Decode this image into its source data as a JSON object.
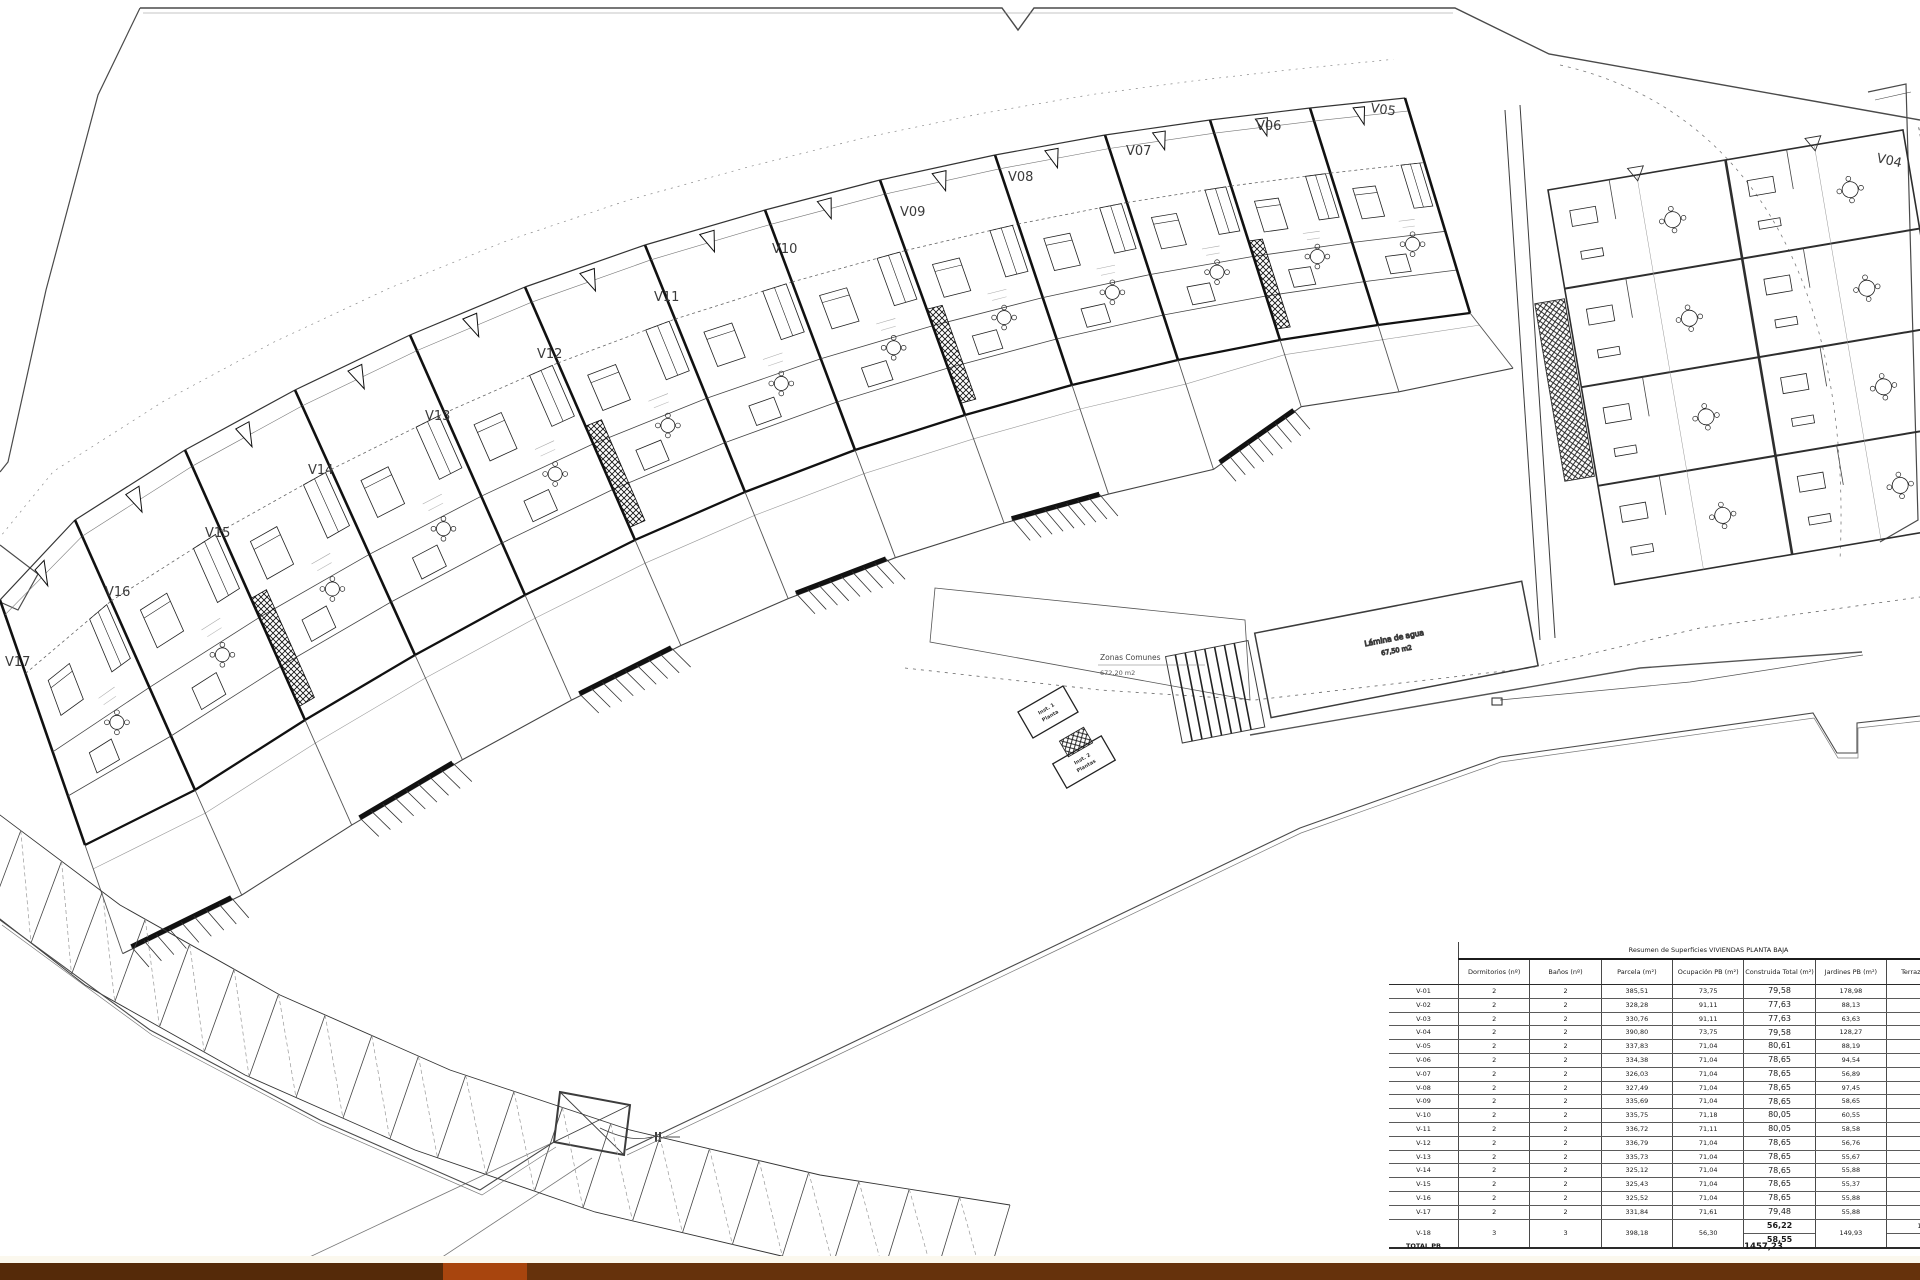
{
  "plan": {
    "unit_labels": [
      "V04",
      "V05",
      "V06",
      "V07",
      "V08",
      "V09",
      "V10",
      "V11",
      "V12",
      "V13",
      "V14",
      "V15",
      "V16",
      "V17"
    ],
    "annotations": {
      "zonas_title": "Zonas Comunes",
      "zonas_area": "672,20 m2",
      "pool_label": "Lámina de agua",
      "pool_area": "67,50 m2",
      "stair1_line1": "Inst. 1",
      "stair1_line2": "Planta",
      "stair2_line1": "Inst. 2",
      "stair2_line2": "Plantas"
    }
  },
  "summary_table": {
    "title": "Resumen de Superficies VIVIENDAS PLANTA BAJA",
    "columns": [
      "",
      "Dormitorios (nº)",
      "Baños (nº)",
      "Parcela (m²)",
      "Ocupación PB (m²)",
      "Construida Total (m²)",
      "Jardines PB (m²)",
      "Terrazas (m²)"
    ],
    "rows": [
      {
        "id": "V-01",
        "dormitorios": "2",
        "banos": "2",
        "parcela": "385,51",
        "ocupacion": "73,75",
        "construida": "79,58",
        "jardines": "178,98",
        "terrazas": "-"
      },
      {
        "id": "V-02",
        "dormitorios": "2",
        "banos": "2",
        "parcela": "328,28",
        "ocupacion": "91,11",
        "construida": "77,63",
        "jardines": "88,13",
        "terrazas": "-"
      },
      {
        "id": "V-03",
        "dormitorios": "2",
        "banos": "2",
        "parcela": "330,76",
        "ocupacion": "91,11",
        "construida": "77,63",
        "jardines": "63,63",
        "terrazas": "-"
      },
      {
        "id": "V-04",
        "dormitorios": "2",
        "banos": "2",
        "parcela": "390,80",
        "ocupacion": "73,75",
        "construida": "79,58",
        "jardines": "128,27",
        "terrazas": "-"
      },
      {
        "id": "V-05",
        "dormitorios": "2",
        "banos": "2",
        "parcela": "337,83",
        "ocupacion": "71,04",
        "construida": "80,61",
        "jardines": "88,19",
        "terrazas": "-"
      },
      {
        "id": "V-06",
        "dormitorios": "2",
        "banos": "2",
        "parcela": "334,38",
        "ocupacion": "71,04",
        "construida": "78,65",
        "jardines": "94,54",
        "terrazas": "-"
      },
      {
        "id": "V-07",
        "dormitorios": "2",
        "banos": "2",
        "parcela": "326,03",
        "ocupacion": "71,04",
        "construida": "78,65",
        "jardines": "56,89",
        "terrazas": "-"
      },
      {
        "id": "V-08",
        "dormitorios": "2",
        "banos": "2",
        "parcela": "327,49",
        "ocupacion": "71,04",
        "construida": "78,65",
        "jardines": "97,45",
        "terrazas": "-"
      },
      {
        "id": "V-09",
        "dormitorios": "2",
        "banos": "2",
        "parcela": "335,69",
        "ocupacion": "71,04",
        "construida": "78,65",
        "jardines": "58,65",
        "terrazas": "-"
      },
      {
        "id": "V-10",
        "dormitorios": "2",
        "banos": "2",
        "parcela": "335,75",
        "ocupacion": "71,18",
        "construida": "80,05",
        "jardines": "60,55",
        "terrazas": "-"
      },
      {
        "id": "V-11",
        "dormitorios": "2",
        "banos": "2",
        "parcela": "336,72",
        "ocupacion": "71,11",
        "construida": "80,05",
        "jardines": "58,58",
        "terrazas": "-"
      },
      {
        "id": "V-12",
        "dormitorios": "2",
        "banos": "2",
        "parcela": "336,79",
        "ocupacion": "71,04",
        "construida": "78,65",
        "jardines": "56,76",
        "terrazas": "-"
      },
      {
        "id": "V-13",
        "dormitorios": "2",
        "banos": "2",
        "parcela": "335,73",
        "ocupacion": "71,04",
        "construida": "78,65",
        "jardines": "55,67",
        "terrazas": "-"
      },
      {
        "id": "V-14",
        "dormitorios": "2",
        "banos": "2",
        "parcela": "325,12",
        "ocupacion": "71,04",
        "construida": "78,65",
        "jardines": "55,88",
        "terrazas": "-"
      },
      {
        "id": "V-15",
        "dormitorios": "2",
        "banos": "2",
        "parcela": "325,43",
        "ocupacion": "71,04",
        "construida": "78,65",
        "jardines": "55,37",
        "terrazas": "-"
      },
      {
        "id": "V-16",
        "dormitorios": "2",
        "banos": "2",
        "parcela": "325,52",
        "ocupacion": "71,04",
        "construida": "78,65",
        "jardines": "55,88",
        "terrazas": "-"
      },
      {
        "id": "V-17",
        "dormitorios": "2",
        "banos": "2",
        "parcela": "331,84",
        "ocupacion": "71,61",
        "construida": "79,48",
        "jardines": "55,88",
        "terrazas": "-"
      }
    ],
    "v18_row": {
      "id": "V-18",
      "dormitorios": "3",
      "banos": "3",
      "parcela": "398,18",
      "ocupacion": "56,30",
      "construida_top": "56,22",
      "construida_bottom": "58,55",
      "jardines": "149,93",
      "terrazas_top": "11,",
      "terrazas_bottom": "8"
    },
    "total_label": "TOTAL PB",
    "total_construida": "1457,23"
  },
  "colors": {
    "footer_dark_left": "#552a09",
    "footer_orange": "#a8450e",
    "footer_dark_right": "#66320c"
  }
}
